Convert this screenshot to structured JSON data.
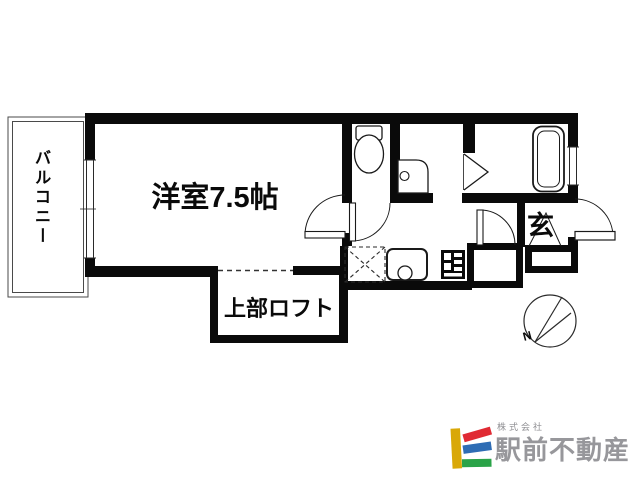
{
  "plan": {
    "balcony_label": "バルコニー",
    "main_room_label": "洋室7.5帖",
    "loft_label": "上部ロフト",
    "entrance_label": "玄",
    "compass_north_label": "N",
    "icons": [
      "toilet-icon",
      "washbasin-icon",
      "bathtub-icon",
      "kitchen-sink-icon",
      "stove-icon",
      "washing-machine-space-icon",
      "window-icon",
      "door-swing-icon",
      "folding-door-icon",
      "compass-icon"
    ]
  },
  "branding": {
    "company_prefix": "株式会社",
    "company_name": "駅前不動産",
    "colors": {
      "logo_yellow": "#d9a808",
      "logo_red": "#e02a33",
      "logo_blue": "#2e6cb4",
      "logo_green": "#2aa348",
      "text_gray": "#97979b"
    }
  }
}
